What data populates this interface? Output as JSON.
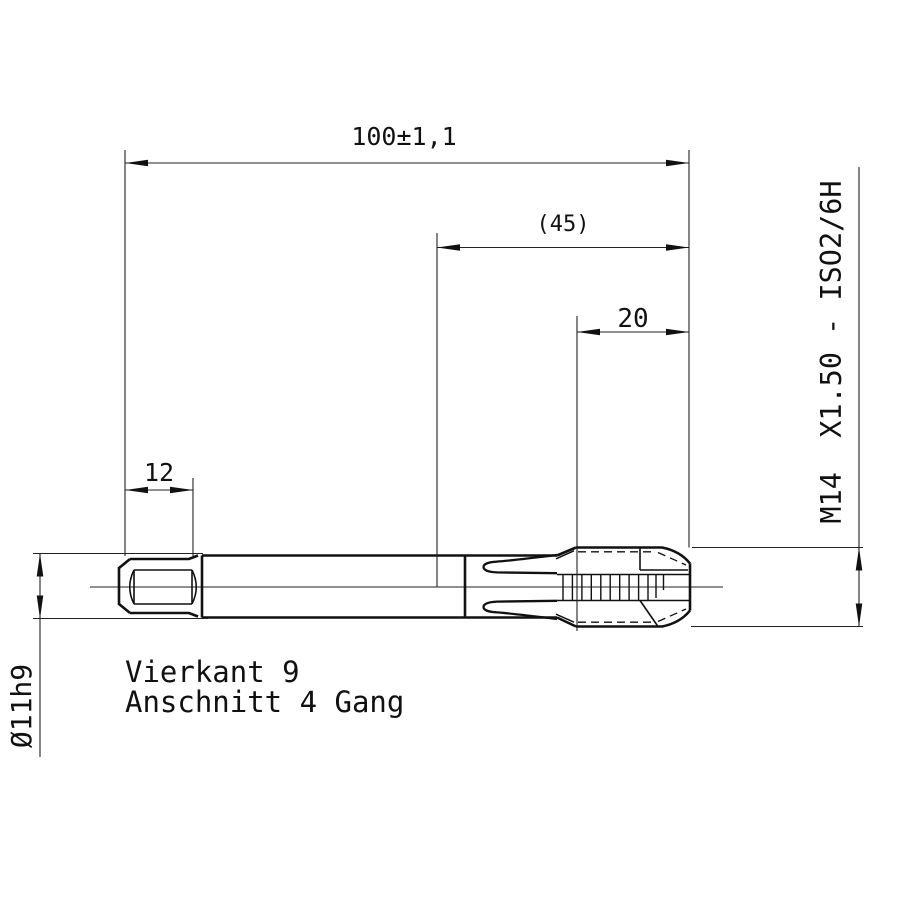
{
  "drawing": {
    "type": "technical-drawing-tap",
    "dimensions": {
      "overall_length": "100±1,1",
      "flute_length_ref": "(45)",
      "thread_length": "20",
      "square_length": "12",
      "shank_diameter": "Ø11h9",
      "thread_spec": "M14  X1.50 - ISO2/6H"
    },
    "notes": {
      "line1": "Vierkant 9",
      "line2": "Anschnitt 4 Gang"
    },
    "colors": {
      "line": "#111111",
      "background": "#ffffff"
    }
  }
}
